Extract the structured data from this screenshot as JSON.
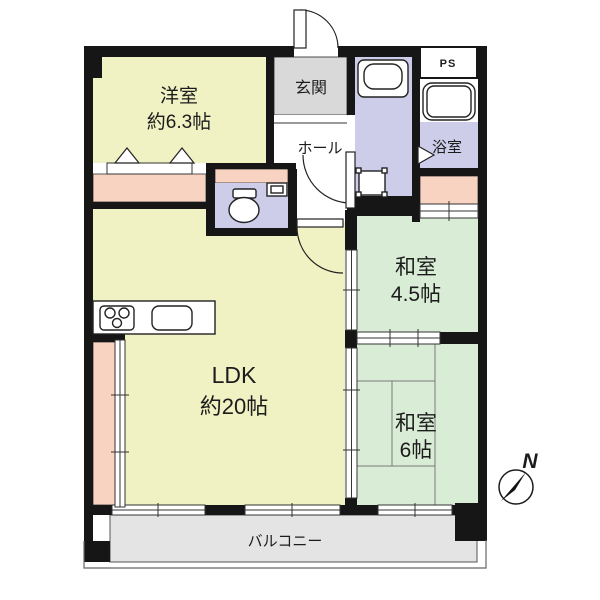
{
  "colors": {
    "wall": "#161616",
    "room_yellow": "#f0f2c3",
    "room_green": "#d9ecd6",
    "room_purple": "#cdcdea",
    "closet_pink": "#f8d3c2",
    "entry_gray": "#d9d9d9",
    "balcony_gray": "#e4e4e4"
  },
  "rooms": {
    "western": {
      "name": "洋室",
      "size": "約6.3帖"
    },
    "entrance": {
      "name": "玄関"
    },
    "hall": {
      "name": "ホール"
    },
    "pipe_space": {
      "name": "PS"
    },
    "bathroom": {
      "name": "浴室"
    },
    "japanese45": {
      "name": "和室",
      "size": "4.5帖"
    },
    "ldk": {
      "name": "LDK",
      "size": "約20帖"
    },
    "japanese6": {
      "name": "和室",
      "size": "6帖"
    },
    "balcony": {
      "name": "バルコニー"
    }
  },
  "compass": {
    "label": "N"
  },
  "icons": {
    "compass-icon": "circle-with-black-needle",
    "toilet-icon": "bowl-ellipse",
    "bathtub-icon": "rounded-rect",
    "washbasin-icon": "rounded-rect-basin",
    "washing-machine-icon": "square-with-corner-tabs",
    "stove-icon": "three-burner-circles",
    "kitchen-sink-icon": "rounded-rect",
    "door-swing-icon": "quarter-arc",
    "closet-door-icon": "up-triangles",
    "bath-door-icon": "right-triangle"
  }
}
